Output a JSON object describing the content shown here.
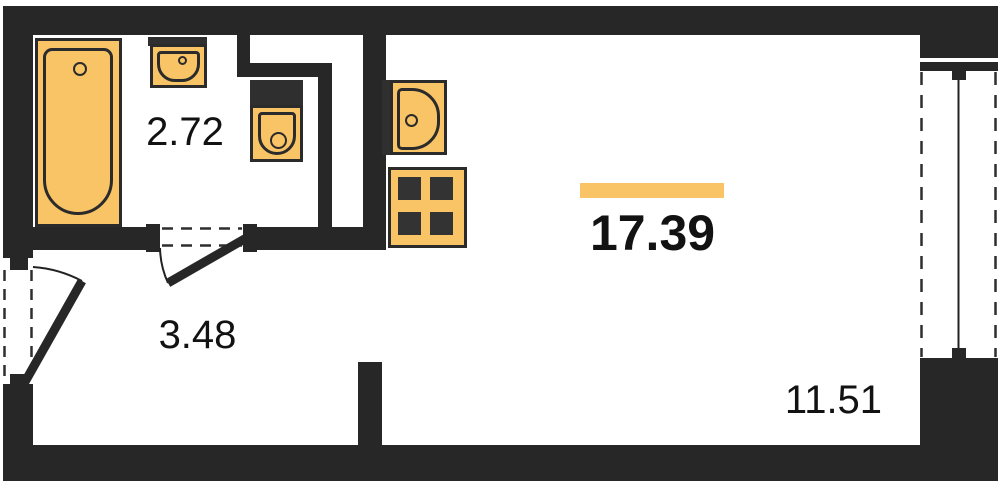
{
  "plan": {
    "title": "studio-apartment-floor-plan",
    "rooms": [
      {
        "id": "bathroom",
        "area_label": "2.72"
      },
      {
        "id": "hallway",
        "area_label": "3.48"
      },
      {
        "id": "living-room",
        "area_label": "17.39",
        "highlighted": true
      },
      {
        "id": "balcony",
        "area_label": "11.51"
      }
    ],
    "fixtures": [
      {
        "id": "bathtub-icon"
      },
      {
        "id": "washbasin-icon"
      },
      {
        "id": "toilet-icon"
      },
      {
        "id": "kitchen-sink-icon"
      },
      {
        "id": "stove-icon"
      },
      {
        "id": "entrance-door-icon"
      },
      {
        "id": "bathroom-door-icon"
      },
      {
        "id": "window-icon"
      }
    ],
    "colors": {
      "wall": "#272727",
      "fixture_fill": "#F9C466",
      "fixture_stroke": "#2b2b2b",
      "accent_bar": "#F9C466",
      "background": "#ffffff",
      "text": "#121212"
    }
  }
}
